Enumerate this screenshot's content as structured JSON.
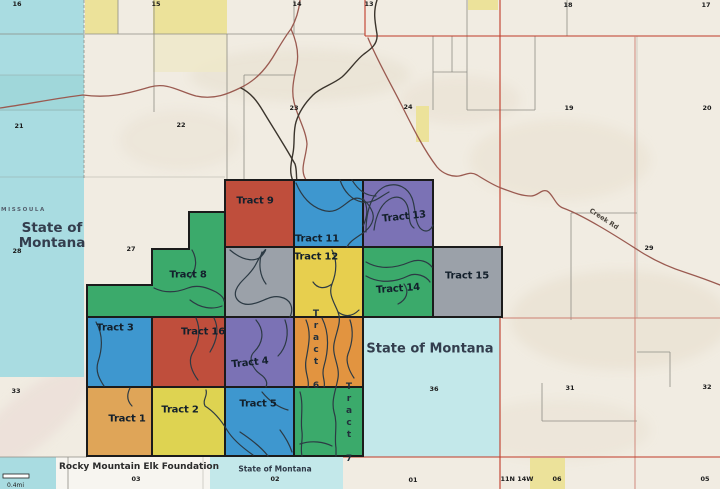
{
  "title": "Land tract parcel map",
  "colors": {
    "terrain": "#f1ece2",
    "water": "#a9dce1",
    "water_light": "#c3e8ea",
    "band_white": "#f7f5f0",
    "yellow_parcel": "#ece29a",
    "yellow_parcel_pale": "#efe8c8",
    "tract_red": "#bf4e3c",
    "tract_blue": "#3e97cf",
    "tract_purple": "#7b72b5",
    "tract_green": "#3baa6b",
    "tract_yellow": "#e7cf4e",
    "tract_yellow2": "#ded351",
    "tract_orange": "#e29440",
    "tract_tan": "#dfa558",
    "tract_gray": "#9ba1a9",
    "boundary_black": "#1b1b1b",
    "line_red": "#c03a28",
    "line_red_pale": "#cd7f72",
    "line_gray": "#8e8d85",
    "road": "#9a5a50",
    "creek": "#3a342c",
    "contour": "#2c3a44",
    "label_dark": "#13202c",
    "label_navy": "#333d4d"
  },
  "tracts": {
    "t1": "Tract 1",
    "t2": "Tract 2",
    "t3": "Tract 3",
    "t4": "Tract 4",
    "t5": "Tract 5",
    "t6": "Tract 6",
    "t7": "Tract 7",
    "t8": "Tract 8",
    "t9": "Tract 9",
    "t11": "Tract 11",
    "t12": "Tract 12",
    "t13": "Tract 13",
    "t14": "Tract 14",
    "t15": "Tract 15",
    "t16": "Tract 16"
  },
  "sections": {
    "16": "16",
    "15": "15",
    "14": "14",
    "13": "13",
    "18": "18",
    "17": "17",
    "21": "21",
    "22": "22",
    "23": "23",
    "24": "24",
    "19": "19",
    "20": "20",
    "28": "28",
    "27": "27",
    "29": "29",
    "33": "33",
    "36": "36",
    "31": "31",
    "32": "32",
    "03": "03",
    "02": "02",
    "01": "01",
    "06": "06",
    "05": "05"
  },
  "places": {
    "county": "MISSOULA",
    "state_left_1": "State of",
    "state_left_2": "Montana",
    "state_right": "State of Montana",
    "state_bottom": "State of Montana",
    "owner": "Rocky Mountain Elk Foundation",
    "road": "Creek Rd",
    "township": "11N 14W",
    "scale": "0.4mi"
  }
}
